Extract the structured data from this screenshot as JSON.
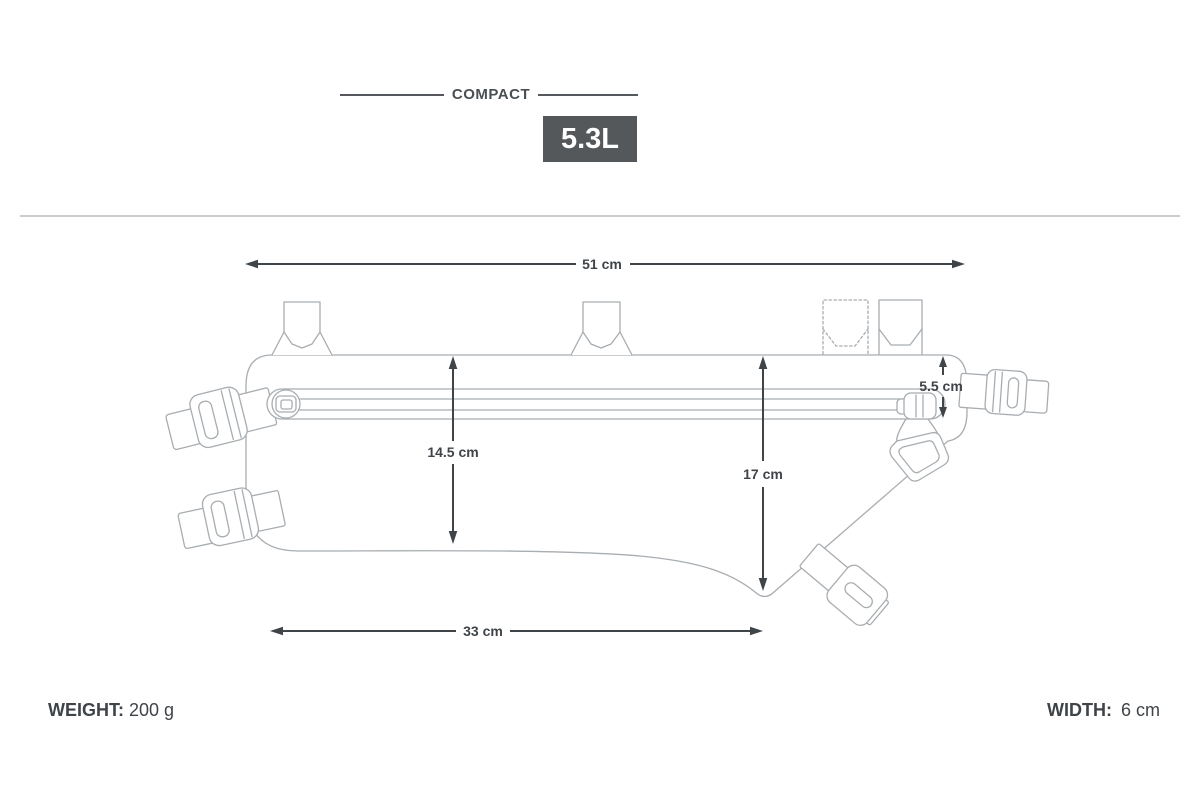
{
  "header": {
    "category_label": "COMPACT",
    "volume_badge": "5.3L"
  },
  "diagram": {
    "dimensions": {
      "top_width": "51 cm",
      "bottom_width": "33 cm",
      "front_height": "14.5 cm",
      "rear_height": "17 cm",
      "top_to_zipper": "5.5 cm"
    }
  },
  "footer": {
    "weight_label": "WEIGHT:",
    "weight_value": "200 g",
    "width_label": "WIDTH:",
    "width_value": "6 cm"
  },
  "colors": {
    "badge_background": "#54585a",
    "badge_text": "#ffffff",
    "dimension_color": "#3f4449",
    "drawing_outline": "#a8adb1",
    "header_rule": "#55595d",
    "divider": "#cbcccd"
  }
}
